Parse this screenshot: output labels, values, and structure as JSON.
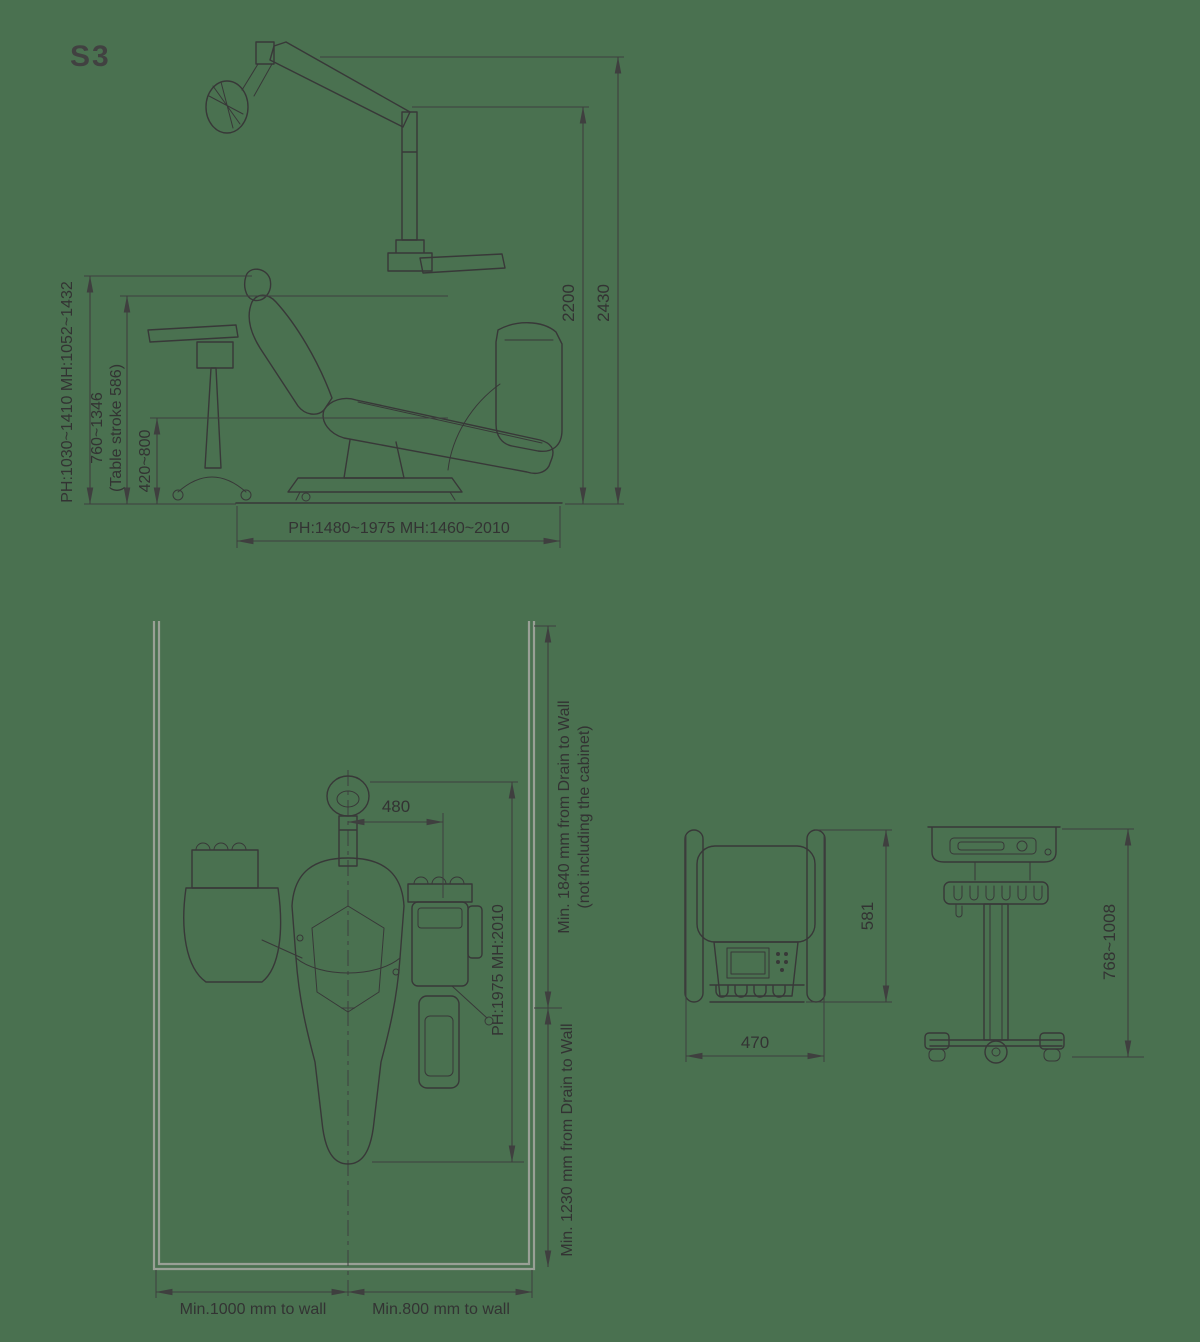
{
  "title": "S3",
  "colors": {
    "background": "#4a7150",
    "line": "#383838",
    "dimension": "#3f3f3f",
    "wall": "#99a096",
    "text": "#333333"
  },
  "side_view": {
    "height_outer": "2430",
    "height_inner": "2200",
    "left_outer": "PH:1030~1410 MH:1052~1432",
    "left_mid_line1": "760~1346",
    "left_mid_line2": "(Table stroke 586)",
    "left_inner": "420~800",
    "bottom_width": "PH:1480~1975 MH:1460~2010"
  },
  "plan_view": {
    "headrest_offset": "480",
    "chair_reach": "PH:1975 MH:2010",
    "drain_top_line1": "Min. 1840 mm from Drain to Wall",
    "drain_top_line2": "(not including the cabinet)",
    "drain_bottom": "Min. 1230 mm from Drain to Wall",
    "wall_left": "Min.1000 mm to wall",
    "wall_right": "Min.800 mm to wall"
  },
  "stool_view": {
    "height": "581",
    "width": "470"
  },
  "cart_view": {
    "height": "768~1008"
  }
}
